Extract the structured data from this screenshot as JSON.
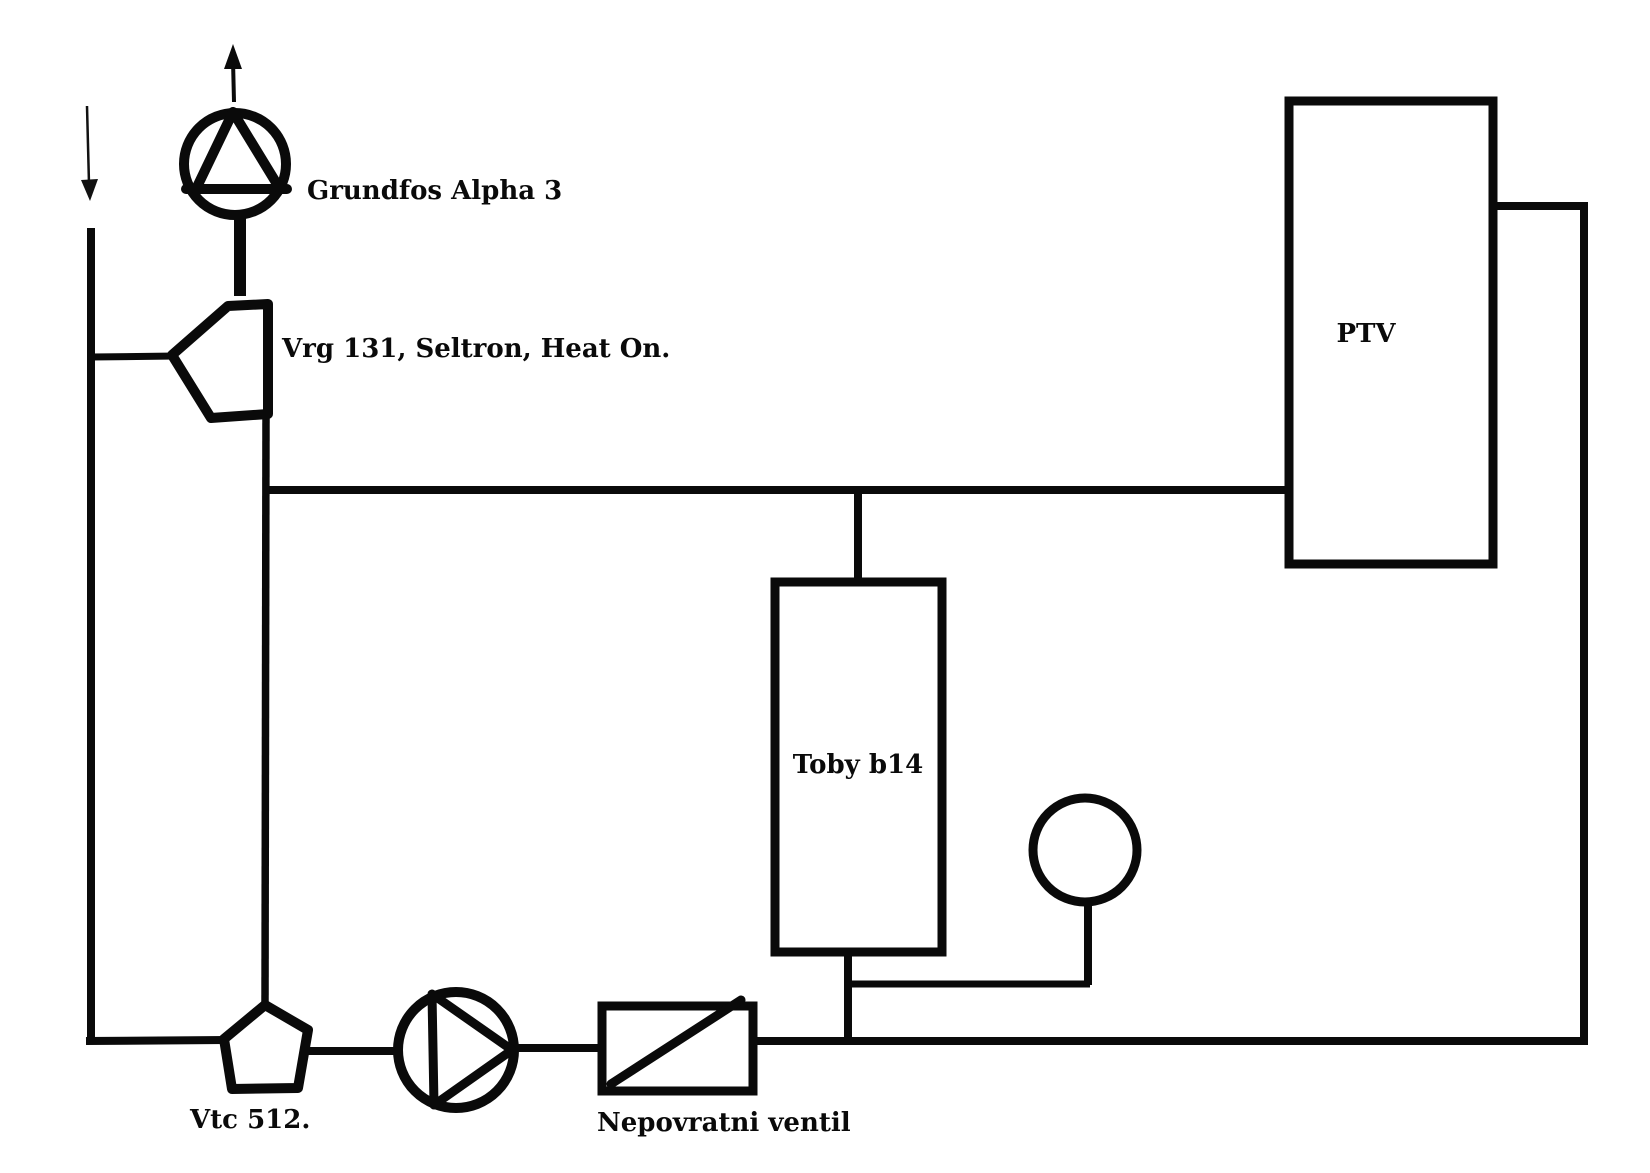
{
  "page": {
    "background": "#ffffff",
    "line_color": "#0a0a0a"
  },
  "components": {
    "inlet_flow": {
      "icon": "arrow-down-icon"
    },
    "supply_pump": {
      "label": "Grundfos Alpha 3",
      "icon": "pump-icon",
      "flow_icon": "arrow-up-icon"
    },
    "mixing_valve": {
      "label": "Vrg 131, Seltron, Heat On.",
      "icon": "three-way-mixing-valve-icon"
    },
    "ptv_tank": {
      "label": "PTV",
      "icon": "tank-rectangle"
    },
    "toby_boiler": {
      "label": "Toby b14",
      "icon": "boiler-rectangle"
    },
    "pressure_gauge": {
      "icon": "gauge-icon"
    },
    "vtc_valve": {
      "label": "Vtc 512.",
      "icon": "thermic-valve-pentagon-icon"
    },
    "circulation_pump": {
      "icon": "pump-icon"
    },
    "check_valve": {
      "label": "Nepovratni ventil",
      "icon": "check-valve-icon"
    }
  }
}
